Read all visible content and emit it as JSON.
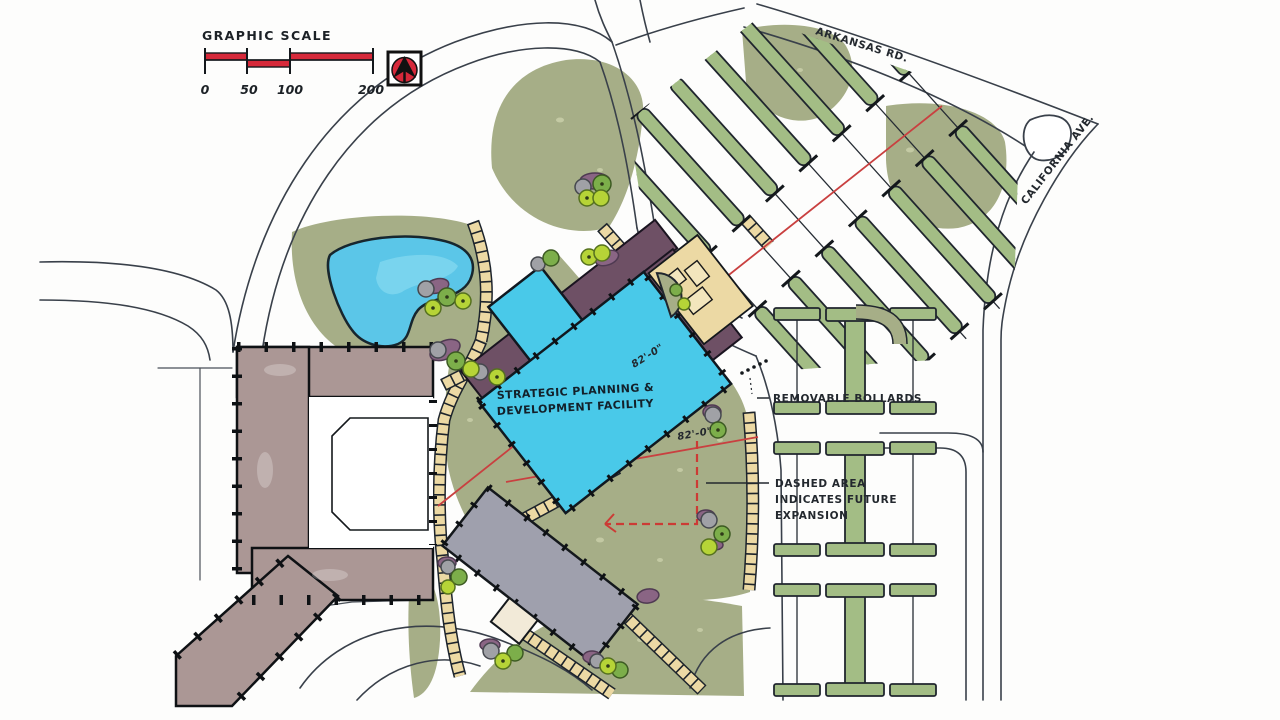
{
  "graphic_scale": {
    "label": "GRAPHIC SCALE",
    "ticks": [
      "0",
      "50",
      "100",
      "200"
    ]
  },
  "roads": {
    "arkansas": "ARKANSAS RD.",
    "california": "CALIFORNIA AVE."
  },
  "facility_label": {
    "line1": "STRATEGIC PLANNING &",
    "line2": "DEVELOPMENT FACILITY"
  },
  "dimensions": {
    "upper": "82'-0\"",
    "lower": "82'-0\""
  },
  "callouts": {
    "bollards": "REMOVABLE BOLLARDS",
    "expansion": [
      "DASHED AREA",
      "INDICATES FUTURE",
      "EXPANSION"
    ]
  },
  "icons": {
    "north_arrow": "north-arrow-icon"
  },
  "colors": {
    "landscape_green": "#a6ae87",
    "parking_island_green": "#a3bd85",
    "water_blue": "#5bc6e8",
    "facility_cyan": "#49c9e9",
    "canopy_plum": "#6e5065",
    "existing_building_taupe": "#ab9795",
    "support_building_gray": "#9fa0ad",
    "walkway_tan": "#ecd9a4",
    "accent_red": "#d6293a",
    "axis_red": "#c94040",
    "ink": "#23282e"
  }
}
